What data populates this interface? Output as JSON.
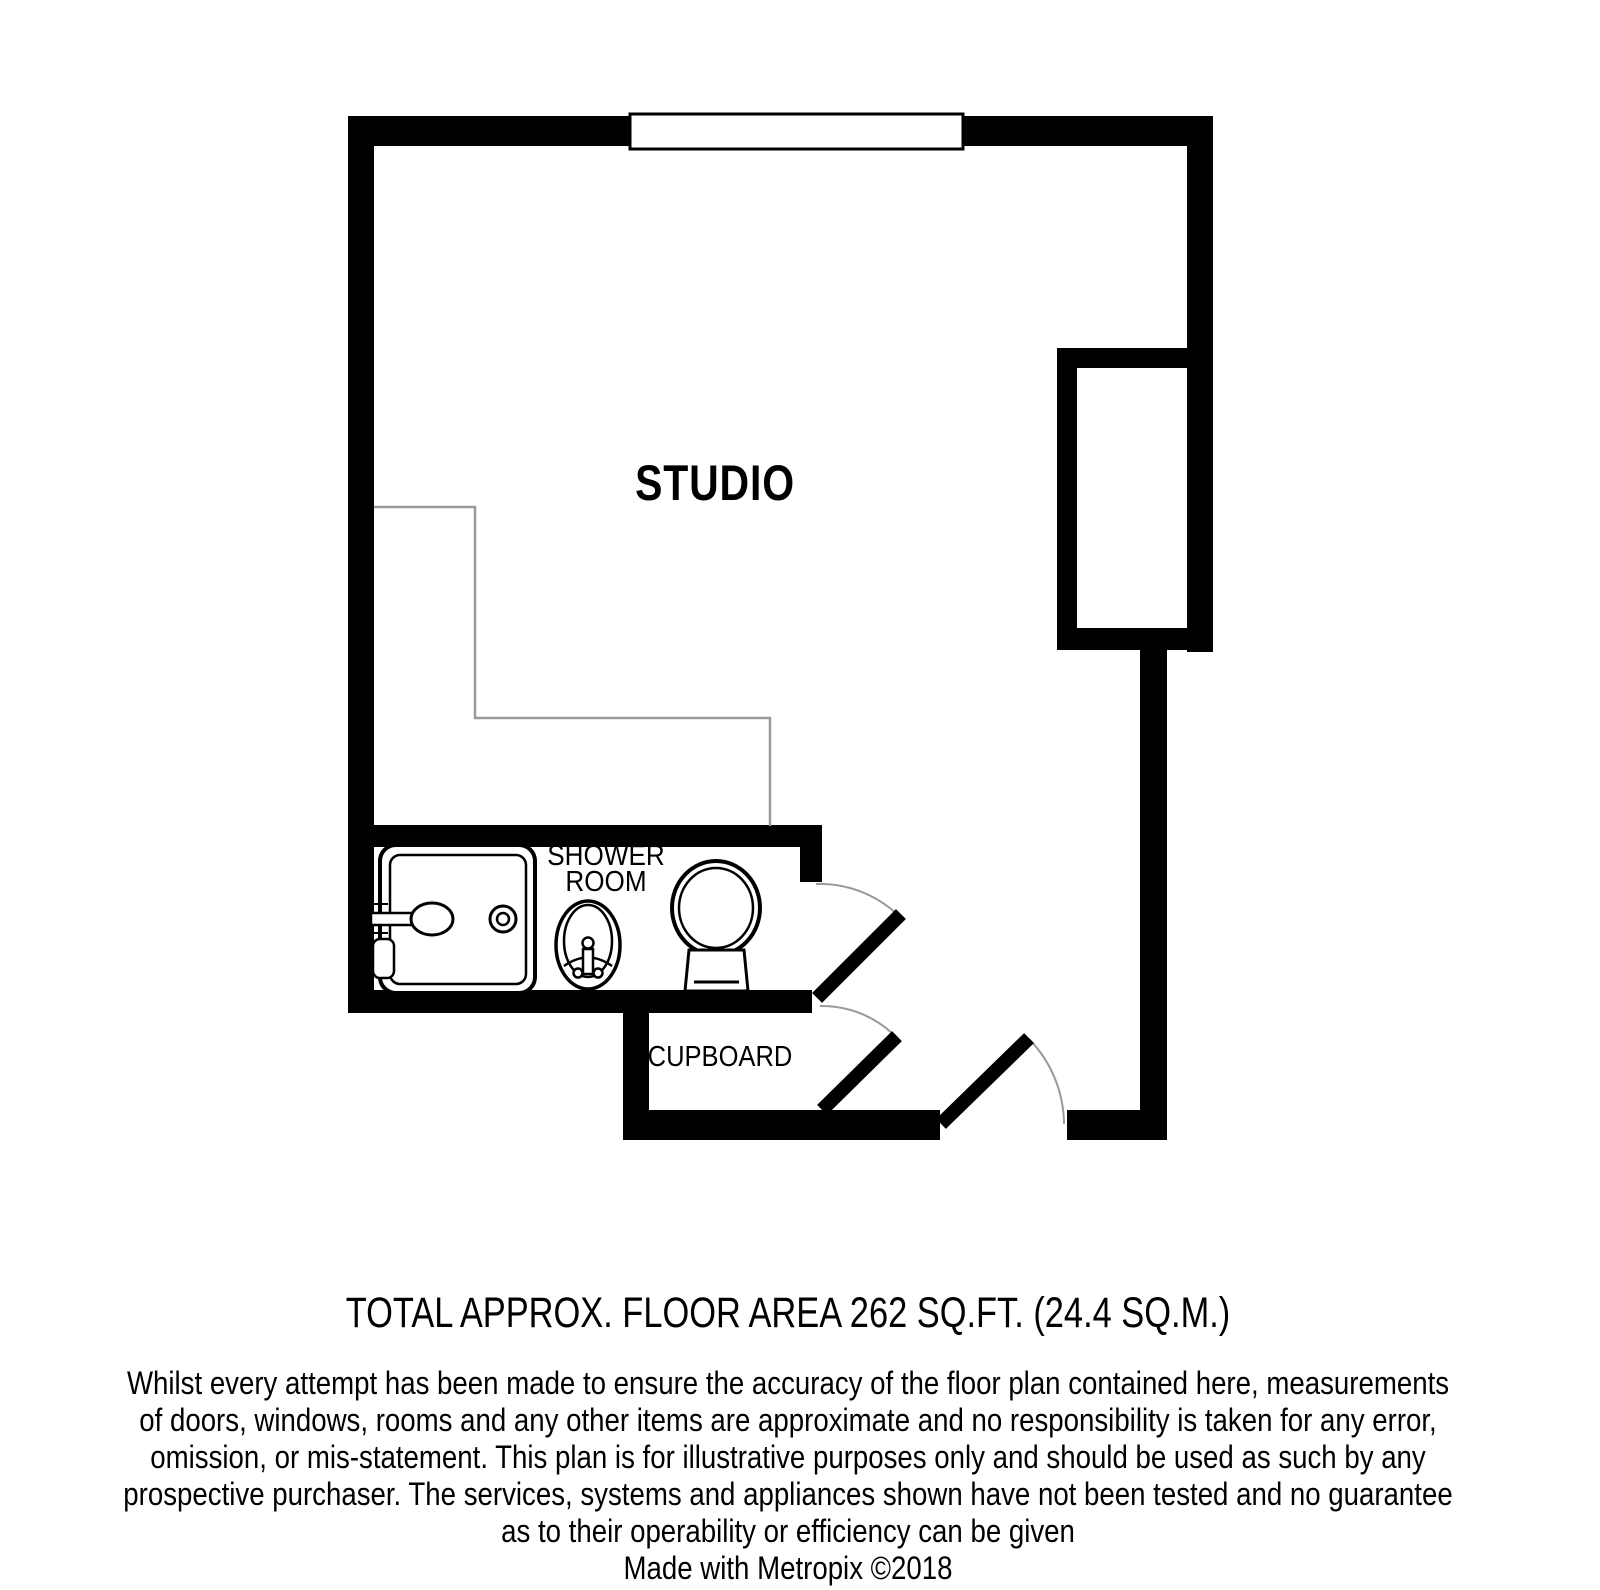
{
  "plan": {
    "labels": {
      "studio": "STUDIO",
      "shower_room_line1": "SHOWER",
      "shower_room_line2": "ROOM",
      "cupboard": "CUPBOARD"
    },
    "colors": {
      "wall": "#000000",
      "fixture_outline": "#000000",
      "door_swing_arc": "#999999",
      "area_divider": "#9a9a9a",
      "background": "#ffffff"
    },
    "symbols": [
      "window-symbol",
      "shower-icon",
      "basin-icon",
      "toilet-icon",
      "door-leaf",
      "door-swing-arc"
    ]
  },
  "caption": {
    "total_area": "TOTAL APPROX. FLOOR AREA 262 SQ.FT. (24.4 SQ.M.)"
  },
  "disclaimer": {
    "lines": [
      "Whilst every attempt has been made to ensure the accuracy of the floor plan contained here, measurements",
      "of doors, windows, rooms and any other items are approximate and no responsibility is taken for any error,",
      "omission, or mis-statement. This plan is for illustrative purposes only and should be used as such by any",
      "prospective purchaser. The services, systems and appliances shown have not been tested and no guarantee",
      "as to their operability or efficiency can be given"
    ],
    "credit": "Made with Metropix ©2018"
  }
}
